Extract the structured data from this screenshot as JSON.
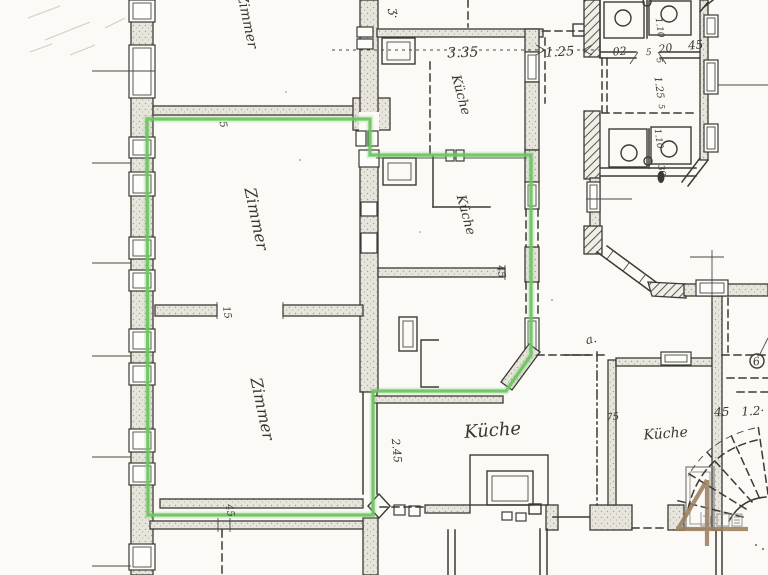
{
  "colors": {
    "paper": "#fbfaf7",
    "ink": "#3c3a34",
    "highlight_green": "#6fc463",
    "logo_brown": "#9c7d5f"
  },
  "rooms": {
    "zimmer_top": "Zimmer",
    "zimmer_1": "Zimmer",
    "zimmer_2": "Zimmer",
    "kueche_top": "Küche",
    "kueche_mid": "Küche",
    "kueche_main": "Küche",
    "kueche_right": "Küche"
  },
  "dims": {
    "d335": "3.35",
    "d125": "1.25",
    "d02": "02",
    "d5": "5",
    "d20": "20",
    "d45": "45",
    "v110a": "1.10",
    "v125": "1.25",
    "v5": "5",
    "v5c": "5",
    "v110b": "1.10",
    "v30": "30",
    "v15": "15",
    "v5b": "5",
    "v45a": "45",
    "v45b": "45",
    "v245": "2.45",
    "d75": "75",
    "d45b": "45",
    "d12": "1.2·",
    "d6": "6",
    "note_a": "a.",
    "scribble": "ʒ·"
  },
  "logo": {
    "numeral": "4"
  }
}
